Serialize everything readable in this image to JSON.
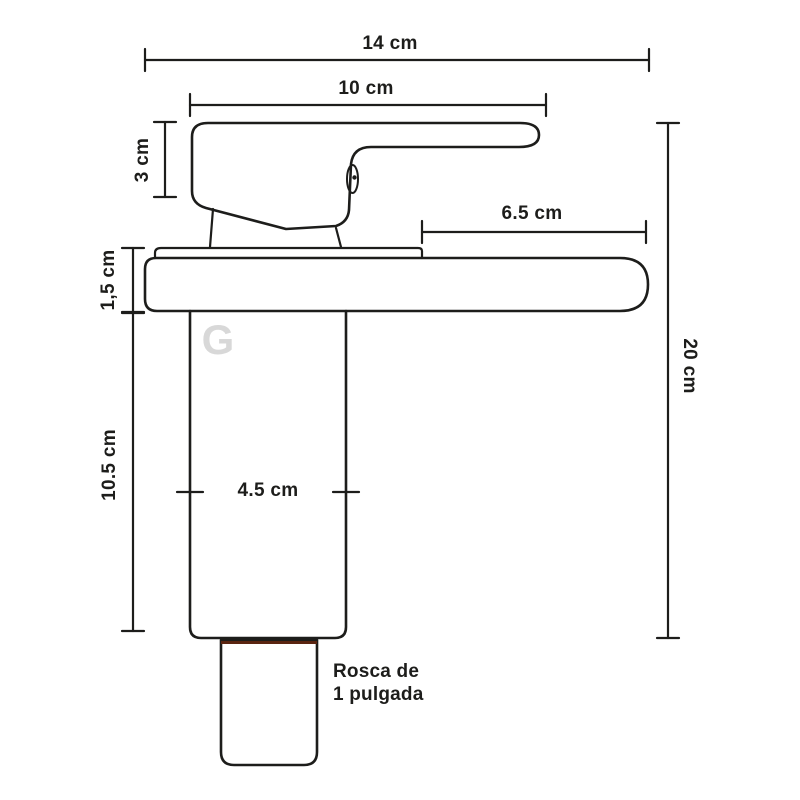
{
  "dimensions": {
    "total_width": "14 cm",
    "handle_length": "10 cm",
    "handle_height": "3 cm",
    "spout_reach": "6.5 cm",
    "deck_thickness": "1,5 cm",
    "body_height": "10.5 cm",
    "body_width": "4.5 cm",
    "total_height": "20 cm"
  },
  "notes": {
    "thread_line1": "Rosca de",
    "thread_line2": "1 pulgada"
  },
  "watermark": {
    "letter": "G"
  },
  "colors": {
    "line": "#1d1d1b",
    "thread_fill": "#f6a733",
    "thread_stripe": "#7b2c12",
    "thread_top_edge": "#5a2410",
    "watermark": "#d8d8d8",
    "background": "#ffffff"
  }
}
